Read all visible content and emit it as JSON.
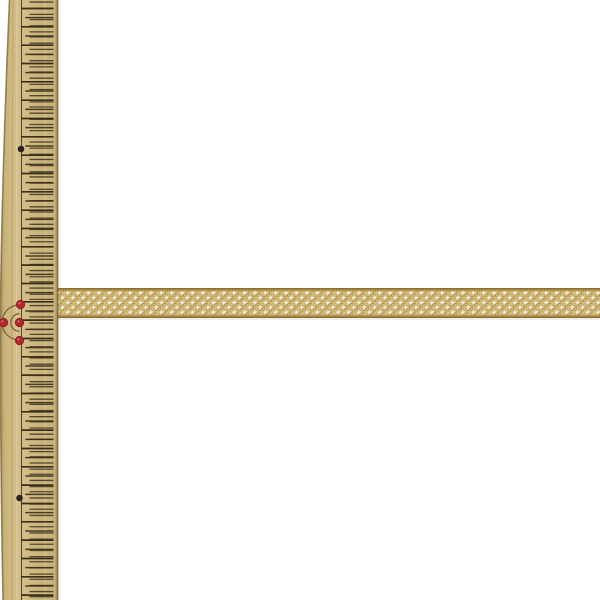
{
  "scene": {
    "description": "Product photograph: a gold metallic net (mesh/tulle) ribbon laid horizontally across a white background, with a vertical wooden centimeter ruler along the left edge for scale",
    "background_color": "#ffffff"
  },
  "ruler": {
    "kind": "wooden-cm-ruler",
    "orientation": "vertical",
    "wood_color": "#c9b379",
    "wood_light": "#d4c08b",
    "wood_shade": "#a68f5b",
    "edge_line_color": "#7f6a42",
    "tick_color": "#3a2f1c",
    "scale_line_x": 21.5,
    "cm_tick_spacing_px": 18.333,
    "cm_tick_offset_px": 8.5,
    "fine_tick_spacing_px": 5.83,
    "cm_tick_x": [
      21.3,
      53.5
    ],
    "half_cm_tick_x": [
      25.3,
      53.5
    ],
    "fine_tick_x": [
      29.5,
      53.5
    ],
    "red_marker_color": "#b4262c",
    "red_marker_edge": "#8c1b20",
    "black_marker_color": "#2b2522",
    "arc_color": "#6a5335",
    "red_markers": [
      [
        20.5,
        304.5
      ],
      [
        3.5,
        322.5
      ],
      [
        19.5,
        322.5
      ],
      [
        19.5,
        340.5
      ]
    ],
    "black_markers": [
      [
        21,
        149
      ],
      [
        19.5,
        498
      ]
    ],
    "arc_center": [
      19.5,
      322.5
    ],
    "arc_radii": [
      17.5,
      8.75
    ]
  },
  "ribbon": {
    "kind": "gold-net-mesh-ribbon",
    "base_color": "#f0ebdd",
    "cell_shadow_color": "#ddd8c9",
    "thread_color": "#b2914a",
    "thread_highlight": "#dcc782",
    "selvage_color": "#a0823a",
    "selvage_dark": "#8a6f2f",
    "left_px": 56,
    "top_px": 288,
    "height_px": 30,
    "right_px": 600
  }
}
